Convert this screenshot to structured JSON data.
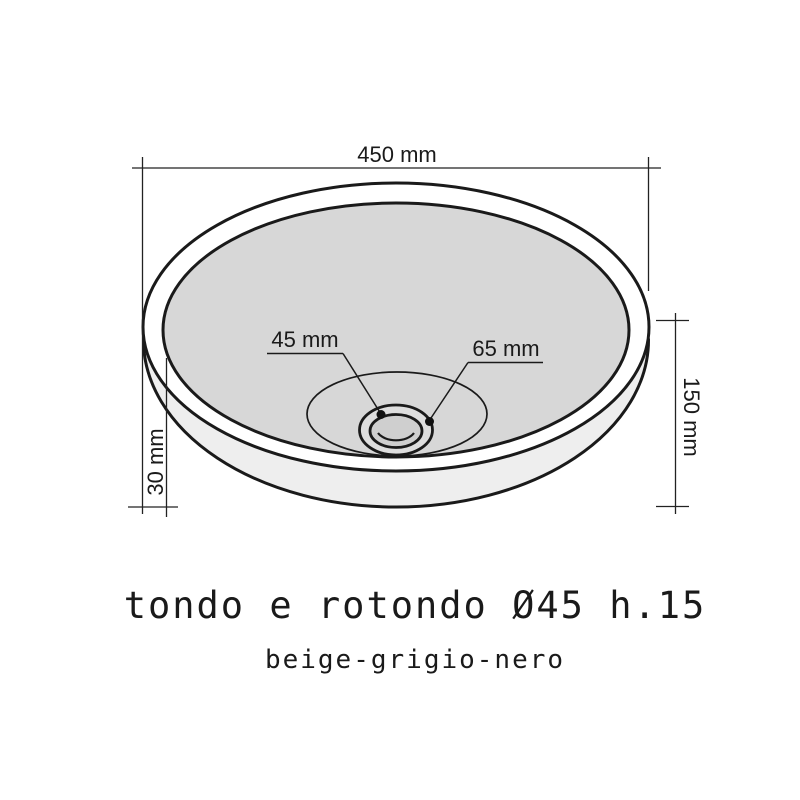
{
  "drawing": {
    "product_title": "tondo e rotondo Ø45 h.15",
    "product_subtitle": "beige-grigio-nero",
    "dimensions": {
      "top_diameter": "450 mm",
      "drain_hole_diameter": "45 mm",
      "drain_ring_diameter": "65 mm",
      "total_height": "150 mm",
      "rim_lip_height": "30 mm"
    },
    "colors": {
      "background": "#ffffff",
      "line": "#1a1a1a",
      "dimension_line": "#222222",
      "rim_fill": "#ffffff",
      "basin_fill": "#d7d7d7",
      "body_side_fill": "#eeeeee",
      "drain_ring_fill": "#dedede",
      "drain_hole_fill": "#cfcfcf",
      "marker_dot": "#111111"
    }
  }
}
